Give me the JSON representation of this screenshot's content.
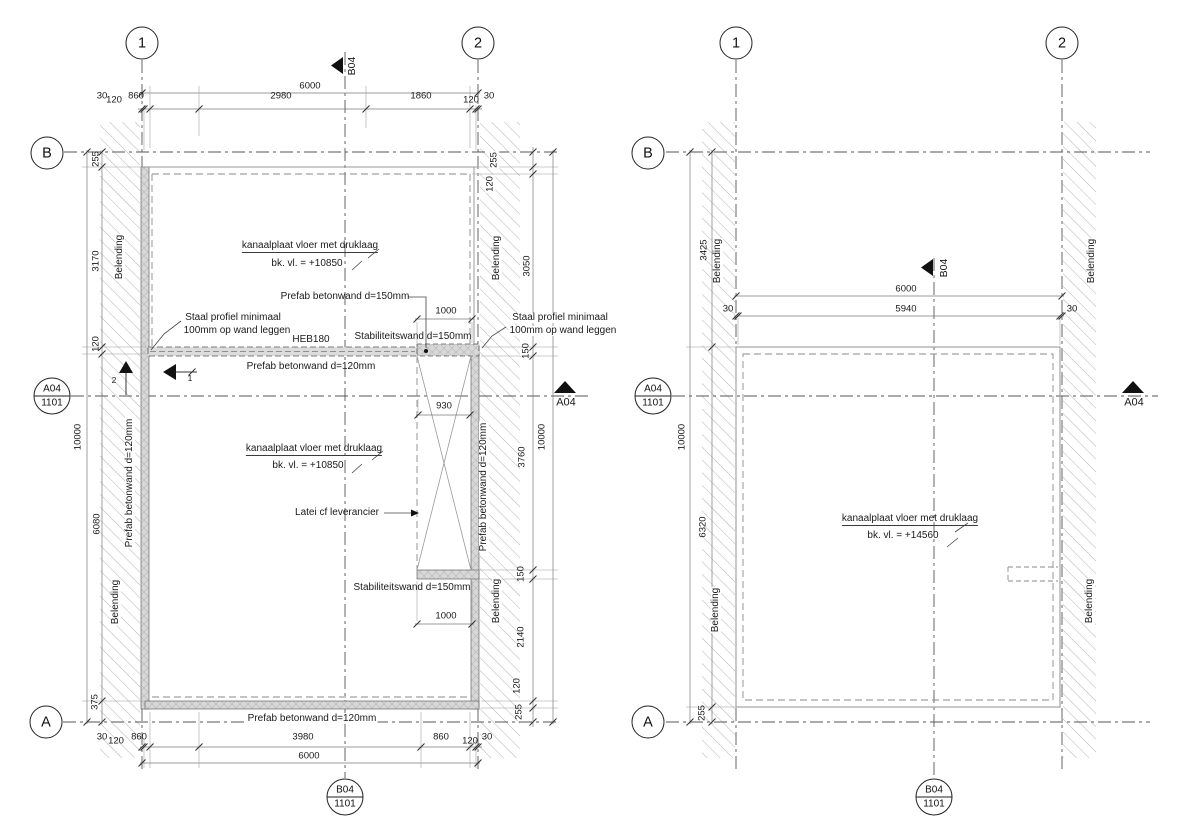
{
  "grid": {
    "c1": "1",
    "c2": "2",
    "rA": "A",
    "rB": "B"
  },
  "sect": {
    "a04": "A04",
    "b04": "B04",
    "sheet": "1101",
    "d1": "1",
    "d2": "2"
  },
  "lp": {
    "top": {
      "overall": "6000",
      "s": [
        "30",
        "120",
        "860",
        "2980",
        "1860",
        "120",
        "30"
      ]
    },
    "bottom": {
      "overall": "6000",
      "s": [
        "30",
        "120",
        "860",
        "3980",
        "860",
        "120",
        "30"
      ]
    },
    "left": {
      "overall": "10000",
      "s": [
        "255",
        "3170",
        "120",
        "6080",
        "375"
      ]
    },
    "right": {
      "overall": "10000",
      "s": [
        "255",
        "120",
        "3050",
        "150",
        "3760",
        "150",
        "2140",
        "120",
        "255"
      ]
    },
    "inner": {
      "a": "1000",
      "b": "930",
      "c": "1000"
    },
    "lbl": {
      "kanaal": "kanaalplaat vloer met druklaag",
      "bk": "bk. vl. = +10850",
      "prefab150": "Prefab betonwand d=150mm",
      "staal1": "Staal profiel minimaal",
      "staal2": "100mm op wand leggen",
      "heb": "HEB180",
      "stab": "Stabiliteitswand d=150mm",
      "prefab120": "Prefab betonwand d=120mm",
      "latei": "Latei cf leverancier",
      "belending": "Belending"
    }
  },
  "rp": {
    "top": {
      "overall": "6000",
      "inner": "5940",
      "edge": "30"
    },
    "left": {
      "overall": "10000",
      "s": [
        "3425",
        "6320",
        "255"
      ]
    },
    "lbl": {
      "kanaal": "kanaalplaat vloer met druklaag",
      "bk": "bk. vl. = +14560",
      "belending": "Belending"
    }
  },
  "colors": {
    "line": "#3c3c3c",
    "wallfill": "#d8d8d8",
    "hatch": "#a8a8a8"
  }
}
